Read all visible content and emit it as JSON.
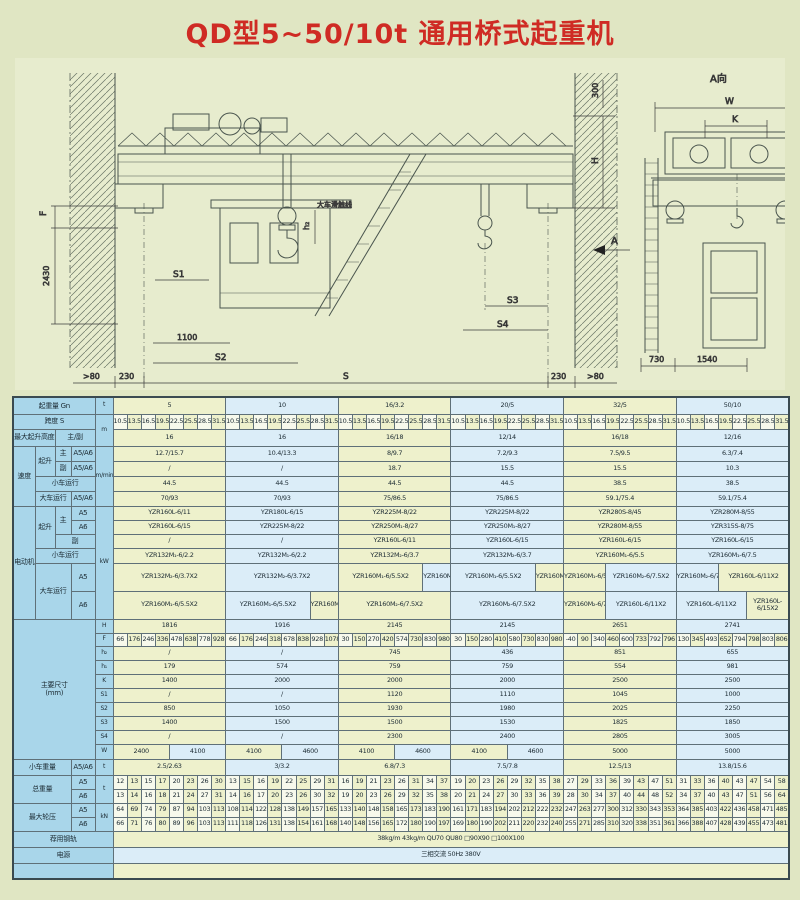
{
  "title": "QD型5~50/10t 通用桥式起重机",
  "drawing": {
    "view_a": "A向",
    "view_arrow": "A",
    "conductor_label": "大车滑触线",
    "dim_F": "F",
    "dim_2430": "2430",
    "dim_S1": "S1",
    "dim_1100": "1100",
    "dim_S2": "S2",
    "dim_gt80_left": ">80",
    "dim_230_left": "230",
    "dim_S": "S",
    "dim_230_right": "230",
    "dim_gt80_right": ">80",
    "dim_300": "300",
    "dim_H": "H",
    "dim_S3": "S3",
    "dim_S4": "S4",
    "dim_h2": "h₂",
    "dim_W": "W",
    "dim_K": "K",
    "dim_730": "730",
    "dim_1540": "1540"
  },
  "table": {
    "rows": [
      [
        17,
        [
          "起重量 Gn",
          "h",
          4
        ],
        [
          "t",
          "u"
        ],
        [
          "5",
          "y",
          8
        ],
        [
          "10",
          "b",
          8
        ],
        [
          "16/3.2",
          "y",
          8
        ],
        [
          "20/5",
          "b",
          8
        ],
        [
          "32/5",
          "y",
          8
        ],
        [
          "50/10",
          "b",
          8
        ]
      ],
      [
        15,
        [
          "跨度 S",
          "h",
          4
        ],
        [
          "m",
          "u",
          1,
          2
        ],
        {
          "seq": [
            10.5,
            13.5,
            16.5,
            19.5,
            22.5,
            25.5,
            28.5,
            31.5,
            10.5,
            13.5,
            16.5,
            19.5,
            22.5,
            25.5,
            28.5,
            31.5,
            10.5,
            13.5,
            16.5,
            19.5,
            22.5,
            25.5,
            28.5,
            31.5,
            10.5,
            13.5,
            16.5,
            19.5,
            22.5,
            25.5,
            28.5,
            31.5,
            10.5,
            13.5,
            16.5,
            19.5,
            22.5,
            25.5,
            28.5,
            31.5,
            10.5,
            13.5,
            16.5,
            19.5,
            22.5,
            25.5,
            28.5,
            31.5
          ]
        }
      ],
      [
        17,
        [
          "最大起升高度",
          "h",
          2
        ],
        [
          "主/副",
          "h",
          2
        ],
        [
          "16",
          "y",
          8
        ],
        [
          "16",
          "b",
          8
        ],
        [
          "16/18",
          "y",
          8
        ],
        [
          "12/14",
          "b",
          8
        ],
        [
          "16/18",
          "y",
          8
        ],
        [
          "12/16",
          "b",
          8
        ]
      ],
      [
        15,
        [
          "速度",
          "h",
          1,
          4
        ],
        [
          "起升",
          "h",
          1,
          2
        ],
        [
          "主",
          "h"
        ],
        [
          "A5/A6",
          "h"
        ],
        [
          "m/min",
          "u",
          1,
          4
        ],
        [
          "12.7/15.7",
          "y",
          8
        ],
        [
          "10.4/13.3",
          "b",
          8
        ],
        [
          "8/9.7",
          "y",
          8
        ],
        [
          "7.2/9.3",
          "b",
          8
        ],
        [
          "7.5/9.5",
          "y",
          8
        ],
        [
          "6.3/7.4",
          "b",
          8
        ]
      ],
      [
        15,
        [
          "副",
          "h"
        ],
        [
          "A5/A6",
          "h"
        ],
        [
          "/",
          "y",
          8
        ],
        [
          "/",
          "b",
          8
        ],
        [
          "18.7",
          "y",
          8
        ],
        [
          "15.5",
          "b",
          8
        ],
        [
          "15.5",
          "y",
          8
        ],
        [
          "10.3",
          "b",
          8
        ]
      ],
      [
        15,
        [
          "小车运行",
          "h",
          3
        ],
        [
          "44.5",
          "y",
          8
        ],
        [
          "44.5",
          "b",
          8
        ],
        [
          "44.5",
          "y",
          8
        ],
        [
          "44.5",
          "b",
          8
        ],
        [
          "38.5",
          "y",
          8
        ],
        [
          "38.5",
          "b",
          8
        ]
      ],
      [
        15,
        [
          "大车运行",
          "h",
          2
        ],
        [
          "A5/A6",
          "h"
        ],
        [
          "70/93",
          "y",
          8
        ],
        [
          "70/93",
          "b",
          8
        ],
        [
          "75/86.5",
          "y",
          8
        ],
        [
          "75/86.5",
          "b",
          8
        ],
        [
          "59.1/75.4",
          "y",
          8
        ],
        [
          "59.1/75.4",
          "b",
          8
        ]
      ],
      [
        14,
        [
          "电动机",
          "h",
          1,
          6
        ],
        [
          "起升",
          "h",
          1,
          3
        ],
        [
          "主",
          "h",
          1,
          2
        ],
        [
          "A5",
          "h"
        ],
        [
          "kW",
          "u",
          1,
          6
        ],
        [
          "YZR160L-6/11",
          "y",
          8
        ],
        [
          "YZR180L-6/15",
          "b",
          8
        ],
        [
          "YZR225M-8/22",
          "y",
          8
        ],
        [
          "YZR225M-8/22",
          "b",
          8
        ],
        [
          "YZR280S-8/45",
          "y",
          8
        ],
        [
          "YZR280M-8/55",
          "b",
          8
        ]
      ],
      [
        14,
        [
          "A6",
          "h"
        ],
        [
          "YZR160L-6/15",
          "y",
          8
        ],
        [
          "YZR225M-8/22",
          "b",
          8
        ],
        [
          "YZR250M₁-8/27",
          "y",
          8
        ],
        [
          "YZR250M₁-8/27",
          "b",
          8
        ],
        [
          "YZR280M-8/55",
          "y",
          8
        ],
        [
          "YZR315S-8/75",
          "b",
          8
        ]
      ],
      [
        14,
        [
          "副",
          "h",
          2
        ],
        [
          "/",
          "y",
          8
        ],
        [
          "/",
          "b",
          8
        ],
        [
          "YZR160L-6/11",
          "y",
          8
        ],
        [
          "YZR160L-6/15",
          "b",
          8
        ],
        [
          "YZR160L-6/15",
          "y",
          8
        ],
        [
          "YZR160L-6/15",
          "b",
          8
        ]
      ],
      [
        15,
        [
          "小车运行",
          "h",
          3
        ],
        [
          "YZR132M₁-6/2.2",
          "y",
          8
        ],
        [
          "YZR132M₁-6/2.2",
          "b",
          8
        ],
        [
          "YZR132M₂-6/3.7",
          "y",
          8
        ],
        [
          "YZR132M₂-6/3.7",
          "b",
          8
        ],
        [
          "YZR160M₁-6/5.5",
          "y",
          8
        ],
        [
          "YZR160M₁-6/7.5",
          "b",
          8
        ]
      ],
      [
        28,
        [
          "大车运行",
          "h",
          2,
          2
        ],
        [
          "A5",
          "h"
        ],
        [
          "YZR132M₂-6/3.7X2",
          "y",
          8
        ],
        [
          "YZR132M₂-6/3.7X2",
          "b",
          8
        ],
        [
          "YZR160M₁-6/5.5X2",
          "y",
          6
        ],
        [
          "YZR160M₁-6/7.5X2",
          "b",
          2
        ],
        [
          "YZR160M₁-6/5.5X2",
          "b",
          6
        ],
        [
          "YZR160M₁-6/7.5X2",
          "y",
          2
        ],
        [
          "YZR160M₁-6/5.5X2",
          "y",
          3
        ],
        [
          "YZR160M₂-6/7.5X2",
          "b",
          5
        ],
        [
          "YZR160M₂-6/7.5X2",
          "b",
          3
        ],
        [
          "YZR160L-6/11X2",
          "y",
          5
        ]
      ],
      [
        28,
        [
          "A6",
          "h"
        ],
        [
          "YZR160M₁-6/5.5X2",
          "y",
          8
        ],
        [
          "YZR160M₁-6/5.5X2",
          "b",
          6
        ],
        [
          "YZR160M₁-6/7.5X2",
          "y",
          2
        ],
        [
          "YZR160M₂-6/7.5X2",
          "y",
          8
        ],
        [
          "YZR160M₂-6/7.5X2",
          "b",
          8
        ],
        [
          "YZR160M₂-6/7.5X2",
          "y",
          3
        ],
        [
          "YZR160L-6/11X2",
          "b",
          5
        ],
        [
          "YZR160L-6/11X2",
          "b",
          5
        ],
        [
          "YZR160L-6/15X2",
          "y",
          3
        ]
      ],
      [
        14,
        [
          "主要尺寸\n(mm)",
          "h",
          4,
          10
        ],
        [
          "H",
          "u"
        ],
        [
          "1816",
          "y",
          8
        ],
        [
          "1916",
          "b",
          8
        ],
        [
          "2145",
          "y",
          8
        ],
        [
          "2145",
          "b",
          8
        ],
        [
          "2651",
          "y",
          8
        ],
        [
          "2741",
          "b",
          8
        ]
      ],
      [
        13,
        [
          "F",
          "u"
        ],
        {
          "seq": [
            66,
            176,
            246,
            336,
            478,
            638,
            778,
            928,
            66,
            176,
            246,
            318,
            678,
            838,
            928,
            1078,
            30,
            150,
            270,
            420,
            574,
            730,
            830,
            980,
            30,
            150,
            280,
            410,
            580,
            730,
            830,
            980,
            -40,
            90,
            340,
            460,
            600,
            733,
            792,
            796,
            130,
            345,
            493,
            652,
            794,
            798,
            803,
            806
          ]
        }
      ],
      [
        14,
        [
          "h₂",
          "u"
        ],
        [
          "/",
          "y",
          8
        ],
        [
          "/",
          "b",
          8
        ],
        [
          "745",
          "y",
          8
        ],
        [
          "436",
          "b",
          8
        ],
        [
          "851",
          "y",
          8
        ],
        [
          "655",
          "b",
          8
        ]
      ],
      [
        14,
        [
          "h₁",
          "u"
        ],
        [
          "179",
          "y",
          8
        ],
        [
          "574",
          "b",
          8
        ],
        [
          "759",
          "y",
          8
        ],
        [
          "759",
          "b",
          8
        ],
        [
          "554",
          "y",
          8
        ],
        [
          "981",
          "b",
          8
        ]
      ],
      [
        14,
        [
          "K",
          "u"
        ],
        [
          "1400",
          "y",
          8
        ],
        [
          "2000",
          "b",
          8
        ],
        [
          "2000",
          "y",
          8
        ],
        [
          "2000",
          "b",
          8
        ],
        [
          "2500",
          "y",
          8
        ],
        [
          "2500",
          "b",
          8
        ]
      ],
      [
        14,
        [
          "S1",
          "u"
        ],
        [
          "/",
          "y",
          8
        ],
        [
          "/",
          "b",
          8
        ],
        [
          "1120",
          "y",
          8
        ],
        [
          "1110",
          "b",
          8
        ],
        [
          "1045",
          "y",
          8
        ],
        [
          "1000",
          "b",
          8
        ]
      ],
      [
        14,
        [
          "S2",
          "u"
        ],
        [
          "850",
          "y",
          8
        ],
        [
          "1050",
          "b",
          8
        ],
        [
          "1930",
          "y",
          8
        ],
        [
          "1980",
          "b",
          8
        ],
        [
          "2025",
          "y",
          8
        ],
        [
          "2250",
          "b",
          8
        ]
      ],
      [
        14,
        [
          "S3",
          "u"
        ],
        [
          "1400",
          "y",
          8
        ],
        [
          "1500",
          "b",
          8
        ],
        [
          "1500",
          "y",
          8
        ],
        [
          "1530",
          "b",
          8
        ],
        [
          "1825",
          "y",
          8
        ],
        [
          "1850",
          "b",
          8
        ]
      ],
      [
        14,
        [
          "S4",
          "u"
        ],
        [
          "/",
          "y",
          8
        ],
        [
          "/",
          "b",
          8
        ],
        [
          "2300",
          "y",
          8
        ],
        [
          "2400",
          "b",
          8
        ],
        [
          "2805",
          "y",
          8
        ],
        [
          "3005",
          "b",
          8
        ]
      ],
      [
        15,
        [
          "W",
          "u"
        ],
        [
          "2400",
          "y",
          4
        ],
        [
          "4100",
          "b",
          4
        ],
        [
          "4100",
          "y",
          4
        ],
        [
          "4600",
          "b",
          4
        ],
        [
          "4100",
          "y",
          4
        ],
        [
          "4600",
          "b",
          4
        ],
        [
          "4100",
          "y",
          4
        ],
        [
          "4600",
          "b",
          4
        ],
        [
          "5000",
          "y",
          8
        ],
        [
          "5000",
          "b",
          8
        ]
      ],
      [
        16,
        [
          "小车重量",
          "h",
          3
        ],
        [
          "A5/A6",
          "h"
        ],
        [
          "t",
          "u"
        ],
        [
          "2.5/2.63",
          "y",
          8
        ],
        [
          "3/3.2",
          "b",
          8
        ],
        [
          "6.8/7.3",
          "y",
          8
        ],
        [
          "7.5/7.8",
          "b",
          8
        ],
        [
          "12.5/13",
          "y",
          8
        ],
        [
          "13.8/15.6",
          "b",
          8
        ]
      ],
      [
        14,
        [
          "总重量",
          "h",
          3,
          2
        ],
        [
          "A5",
          "h"
        ],
        [
          "t",
          "u",
          1,
          2
        ],
        {
          "seq": [
            12,
            13,
            15,
            17,
            20,
            23,
            26,
            30,
            13,
            15,
            16,
            19,
            22,
            25,
            29,
            31,
            16,
            19,
            21,
            23,
            26,
            31,
            34,
            37,
            19,
            20,
            23,
            26,
            29,
            32,
            35,
            38,
            27,
            29,
            33,
            36,
            39,
            43,
            47,
            51,
            31,
            33,
            36,
            40,
            43,
            47,
            54,
            58
          ]
        }
      ],
      [
        14,
        [
          "A6",
          "h"
        ],
        {
          "seq": [
            13,
            14,
            16,
            18,
            21,
            24,
            27,
            31,
            14,
            16,
            17,
            20,
            23,
            26,
            30,
            32,
            19,
            20,
            23,
            26,
            29,
            32,
            35,
            38,
            20,
            21,
            24,
            27,
            30,
            33,
            36,
            39,
            28,
            30,
            34,
            37,
            40,
            44,
            48,
            52,
            34,
            37,
            40,
            43,
            47,
            51,
            56,
            64
          ]
        }
      ],
      [
        14,
        [
          "最大轮压",
          "h",
          3,
          2
        ],
        [
          "A5",
          "h"
        ],
        [
          "kN",
          "u",
          1,
          2
        ],
        {
          "seq": [
            64,
            69,
            74,
            79,
            87,
            94,
            103,
            113,
            108,
            114,
            122,
            128,
            138,
            149,
            157,
            165,
            133,
            140,
            148,
            158,
            165,
            173,
            183,
            190,
            161,
            171,
            183,
            194,
            202,
            212,
            222,
            232,
            247,
            263,
            277,
            300,
            312,
            330,
            343,
            353,
            364,
            385,
            403,
            422,
            436,
            458,
            471,
            485
          ]
        }
      ],
      [
        14,
        [
          "A6",
          "h"
        ],
        {
          "seq": [
            66,
            71,
            76,
            80,
            89,
            96,
            103,
            113,
            111,
            118,
            126,
            131,
            138,
            154,
            161,
            168,
            140,
            148,
            156,
            165,
            172,
            180,
            190,
            197,
            169,
            180,
            190,
            202,
            211,
            220,
            232,
            240,
            255,
            271,
            285,
            310,
            320,
            338,
            351,
            361,
            366,
            388,
            407,
            428,
            439,
            455,
            473,
            481
          ]
        }
      ],
      [
        16,
        [
          "荐用钢轨",
          "h",
          5
        ],
        [
          "38kg/m  43kg/m  QU70  QU80  □90X90  □100X100",
          "y",
          48
        ]
      ],
      [
        16,
        [
          "电源",
          "h",
          5
        ],
        [
          "三相交流  50Hz  380V",
          "b",
          48
        ]
      ],
      [
        16,
        [
          "",
          "h",
          5
        ],
        [
          "",
          "y",
          48
        ]
      ]
    ]
  }
}
